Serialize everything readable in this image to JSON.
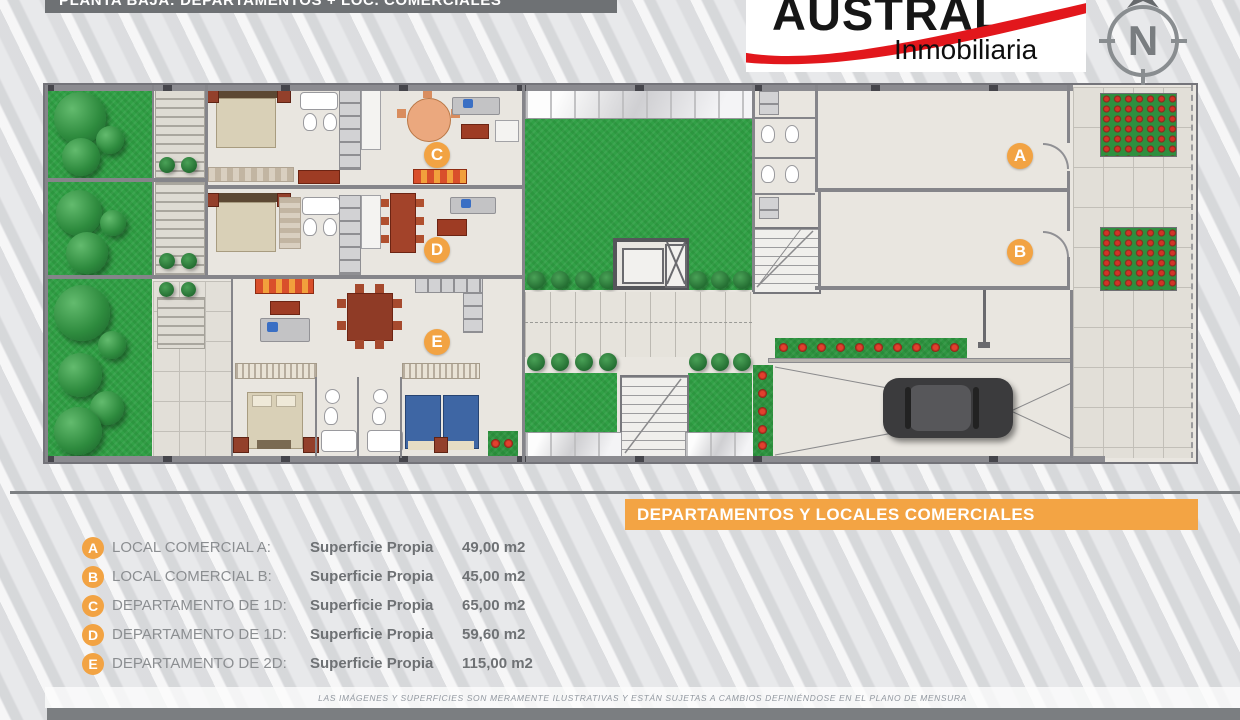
{
  "header": {
    "title": "PLANTA BAJA: DEPARTAMENTOS + LOC. COMERCIALES",
    "logo": {
      "name": "AUSTRAL",
      "subtitle": "Inmobiliaria"
    },
    "compass_letter": "N"
  },
  "banner": {
    "text": "DEPARTAMENTOS Y LOCALES COMERCIALES"
  },
  "plan": {
    "units": [
      {
        "letter": "A"
      },
      {
        "letter": "B"
      },
      {
        "letter": "C"
      },
      {
        "letter": "D"
      },
      {
        "letter": "E"
      }
    ]
  },
  "legend": {
    "items": [
      {
        "letter": "A",
        "name": "LOCAL COMERCIAL A:",
        "label": "Superficie Propia",
        "value": "49,00 m2"
      },
      {
        "letter": "B",
        "name": "LOCAL COMERCIAL B:",
        "label": "Superficie Propia",
        "value": "45,00 m2"
      },
      {
        "letter": "C",
        "name": "DEPARTAMENTO DE 1D:",
        "label": "Superficie Propia",
        "value": "65,00 m2"
      },
      {
        "letter": "D",
        "name": "DEPARTAMENTO DE 1D:",
        "label": "Superficie Propia",
        "value": "59,60 m2"
      },
      {
        "letter": "E",
        "name": "DEPARTAMENTO DE 2D:",
        "label": "Superficie Propia",
        "value": "115,00 m2"
      }
    ]
  },
  "footer": {
    "disclaimer": "LAS IMÁGENES Y SUPERFICIES SON MERAMENTE ILUSTRATIVAS Y ESTÁN SUJETAS A CAMBIOS DEFINIÉNDOSE EN EL PLANO DE MENSURA"
  },
  "colors": {
    "accent_orange": "#F2A343",
    "brand_red": "#E2171C",
    "bar_gray": "#6E7174",
    "grass_green": "#31A046",
    "floor_beige": "#E9E6E0"
  }
}
